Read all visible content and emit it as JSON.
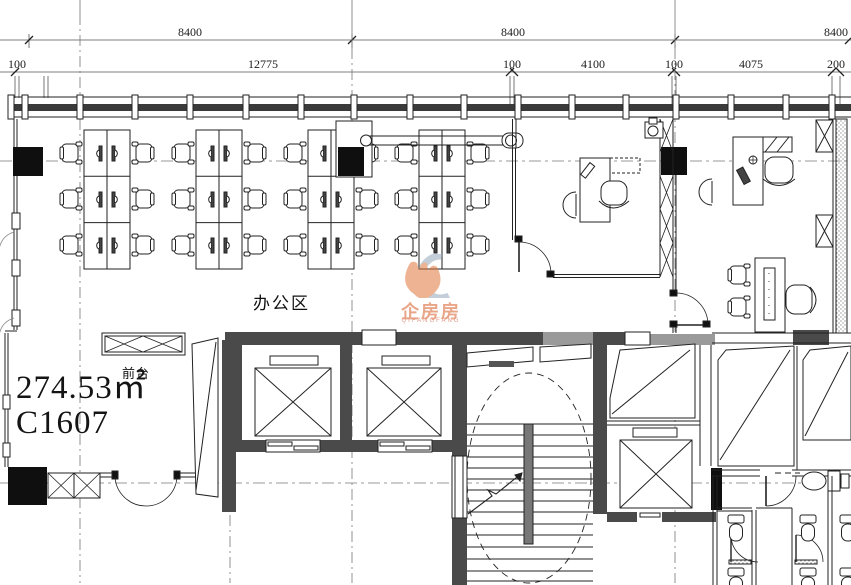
{
  "drawing": {
    "type": "office-floor-plan",
    "unit_no": "C1607",
    "area": "274.53㎡"
  },
  "dimensions": {
    "row1": [
      "8400",
      "8400",
      "8400"
    ],
    "row2": [
      "100",
      "12775",
      "100",
      "4100",
      "100",
      "4075",
      "200"
    ]
  },
  "labels": {
    "office_area": "办公区",
    "reception": "前台"
  },
  "watermark": {
    "brand": "企房房",
    "subtext": "QIFANGFANG",
    "orange": "#E0763A",
    "blue": "#93A7BA"
  },
  "colors": {
    "line": "#222222",
    "wall_fill": "#4a4a4a",
    "light_wall_fill": "#9a9a9a",
    "column_fill": "#0f0f0f",
    "dim_text": "#1c1c1c"
  }
}
